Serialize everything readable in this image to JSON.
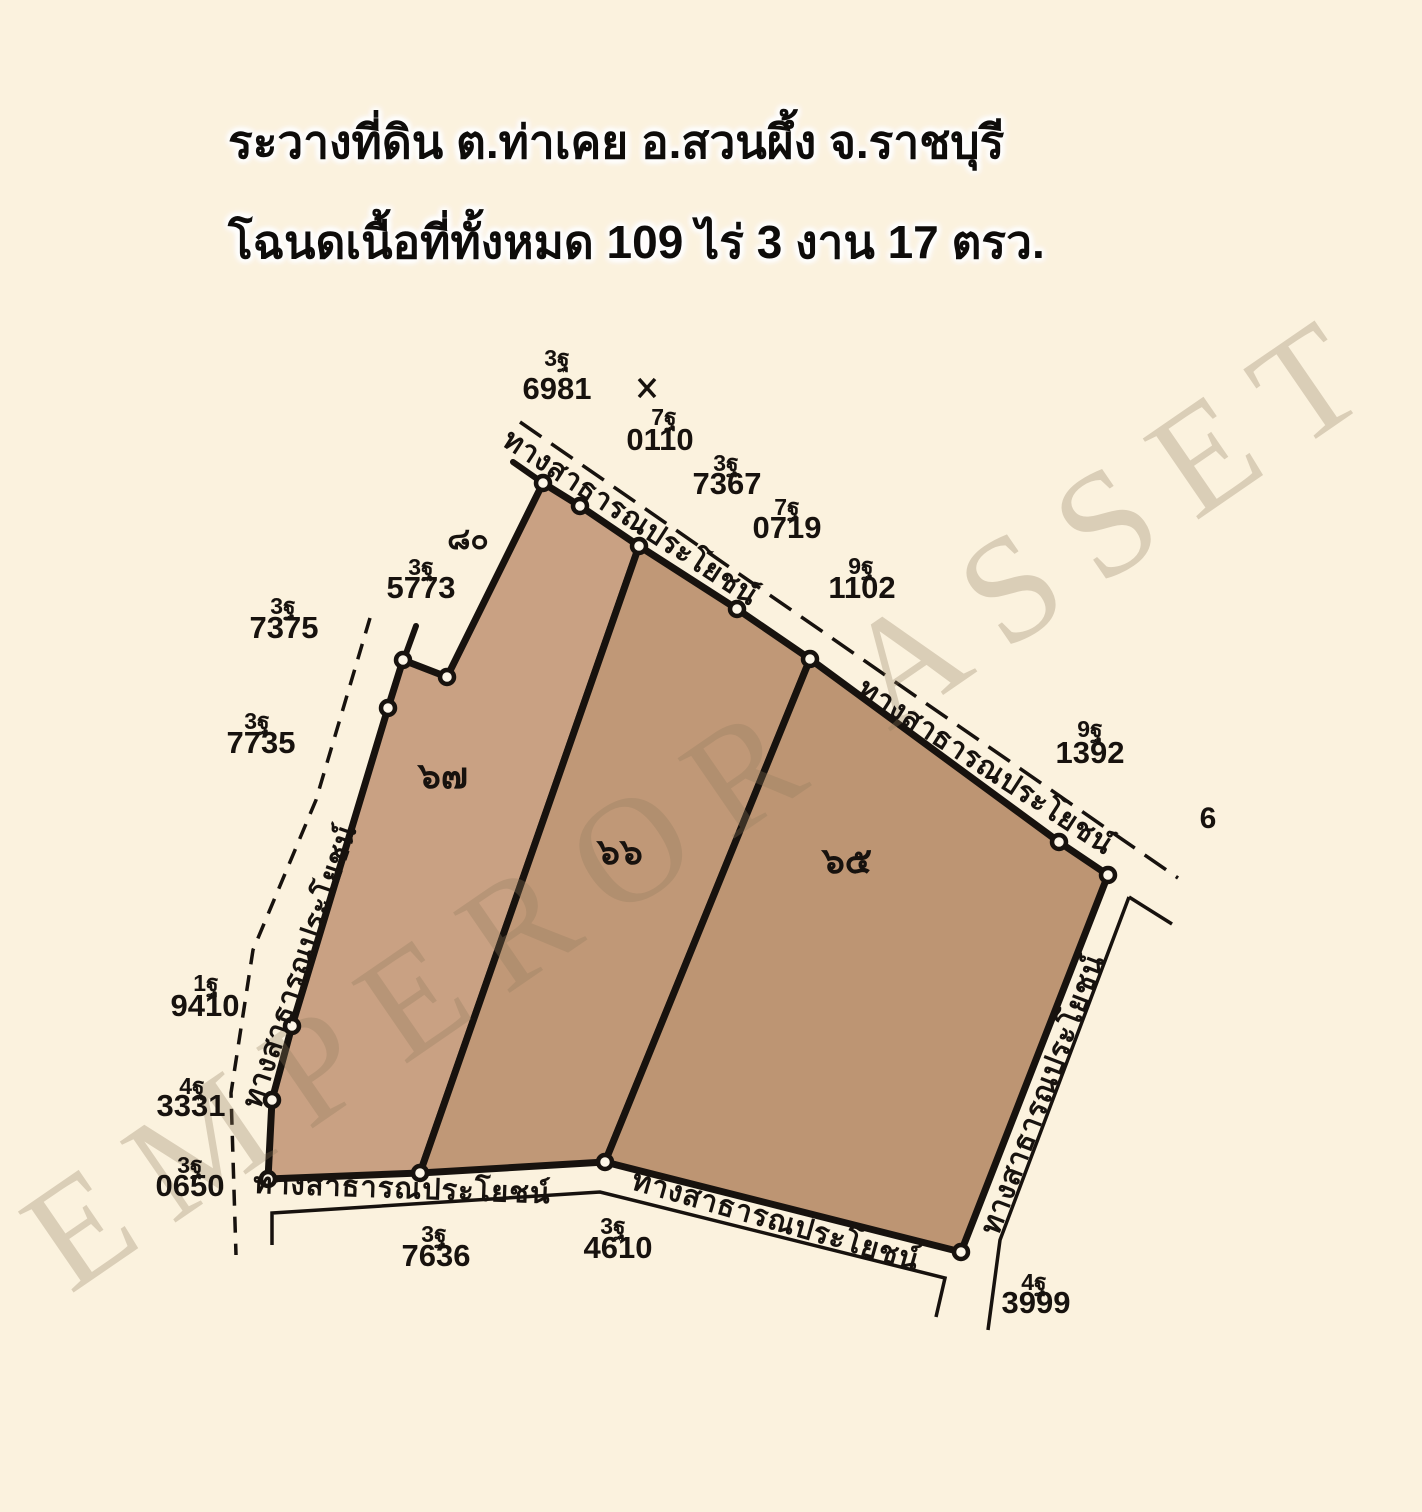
{
  "title": {
    "line1": "ระวางที่ดิน ต.ท่าเคย อ.สวนผึ้ง จ.ราชบุรี",
    "line2": "โฉนดเนื้อที่ทั้งหมด 109 ไร่  3 งาน 17 ตรว."
  },
  "watermark": "EMPEROR ASSET",
  "colors": {
    "background": "#fbf2de",
    "parcel_67": "#c9a183",
    "parcel_66": "#c09877",
    "parcel_65": "#bd9573",
    "ink": "#17120e"
  },
  "map": {
    "road_label": "ทางสาธารณประโยชน์",
    "parcels": [
      {
        "label": "๖๗"
      },
      {
        "label": "๖๖"
      },
      {
        "label": "๖๕"
      }
    ],
    "adjacent": {
      "northwest": "๘๐",
      "east": "6"
    },
    "survey_marks": [
      {
        "sheet": "3ฐ",
        "number": "6981"
      },
      {
        "sheet": "7ฐ",
        "number": "0110"
      },
      {
        "sheet": "3ฐ",
        "number": "7367"
      },
      {
        "sheet": "7ฐ",
        "number": "0719"
      },
      {
        "sheet": "9ฐ",
        "number": "1102"
      },
      {
        "sheet": "9ฐ",
        "number": "1392"
      },
      {
        "sheet": "3ฐ",
        "number": "5773"
      },
      {
        "sheet": "3ฐ",
        "number": "7375"
      },
      {
        "sheet": "3ฐ",
        "number": "7735"
      },
      {
        "sheet": "1ฐ",
        "number": "9410"
      },
      {
        "sheet": "4ฐ",
        "number": "3331"
      },
      {
        "sheet": "3ฐ",
        "number": "0650"
      },
      {
        "sheet": "3ฐ",
        "number": "7636"
      },
      {
        "sheet": "3ฐ",
        "number": "4610"
      },
      {
        "sheet": "4ฐ",
        "number": "3999"
      }
    ]
  }
}
